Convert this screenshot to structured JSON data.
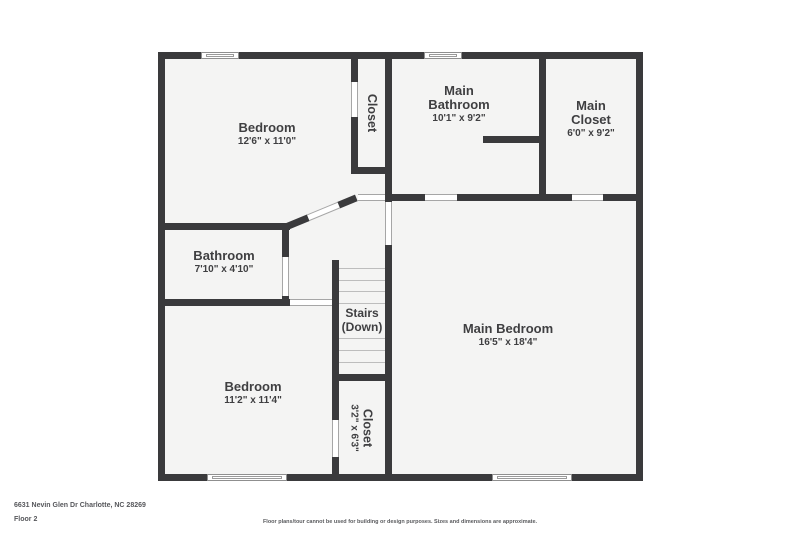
{
  "page": {
    "address": "6631 Nevin Glen Dr Charlotte, NC 28269",
    "floor_label": "Floor 2",
    "disclaimer": "Floor plans/tour cannot be used for building or design purposes. Sizes and dimensions are approximate."
  },
  "colors": {
    "wall": "#3a3a3c",
    "floor": "#f4f4f3",
    "label_text": "#3f3f41",
    "footer_text": "#56575b",
    "background": "#ffffff"
  },
  "rooms": {
    "bedroom_top_left": {
      "name": "Bedroom",
      "dims": "12'6\" x 11'0\""
    },
    "closet_top": {
      "name": "Closet"
    },
    "main_bathroom": {
      "line1": "Main",
      "line2": "Bathroom",
      "dims": "10'1\" x 9'2\""
    },
    "main_closet": {
      "line1": "Main",
      "line2": "Closet",
      "dims": "6'0\" x 9'2\""
    },
    "bathroom": {
      "name": "Bathroom",
      "dims": "7'10\" x 4'10\""
    },
    "stairs": {
      "line1": "Stairs",
      "line2": "(Down)"
    },
    "main_bedroom": {
      "name": "Main Bedroom",
      "dims": "16'5\" x 18'4\""
    },
    "bedroom_bottom_left": {
      "name": "Bedroom",
      "dims": "11'2\" x 11'4\""
    },
    "closet_bottom": {
      "name": "Closet",
      "dims": "3'2\" x 6'3\""
    }
  }
}
